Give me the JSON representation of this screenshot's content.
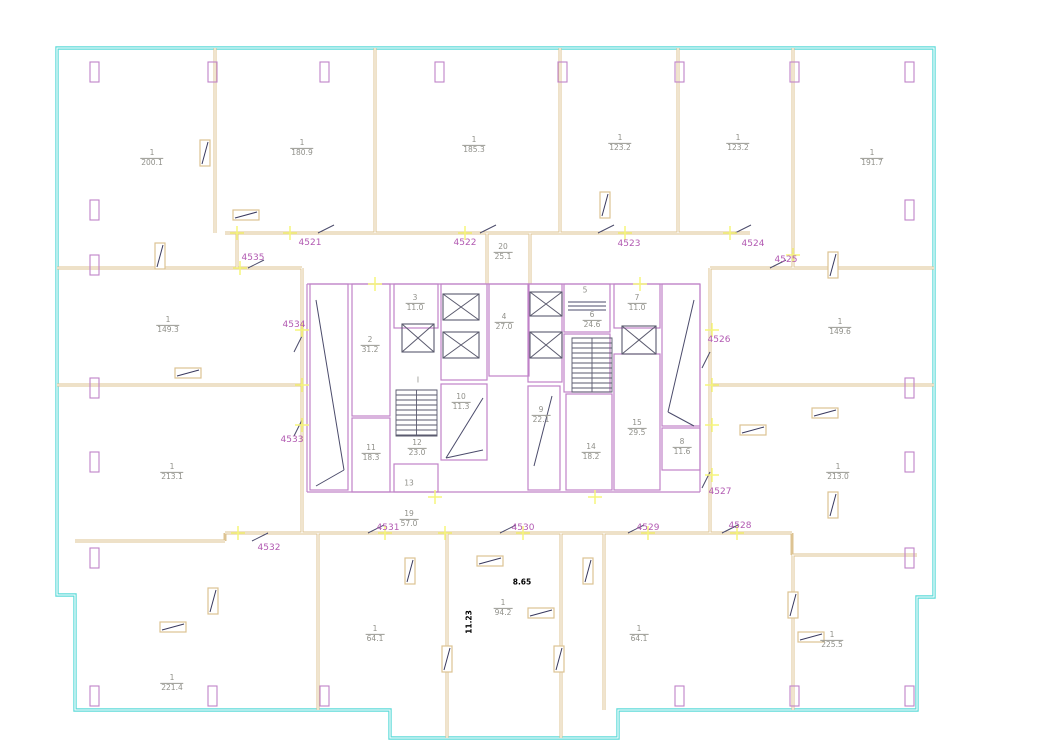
{
  "colors": {
    "boundary": "#5cdad8",
    "wall": "#ddc392",
    "partition": "#c083c8",
    "unit_text": "#b25ab2",
    "room_text": "#90908a",
    "dimension_text": "#000000",
    "junction_cross": "#f5f57c",
    "detail": "#4b4b6b"
  },
  "rooms": {
    "a1": {
      "num": "1",
      "area": "200.1"
    },
    "a2": {
      "num": "1",
      "area": "180.9"
    },
    "a3": {
      "num": "1",
      "area": "185.3"
    },
    "a4": {
      "num": "1",
      "area": "123.2"
    },
    "a5": {
      "num": "1",
      "area": "123.2"
    },
    "a6": {
      "num": "1",
      "area": "191.7"
    },
    "a7": {
      "num": "20",
      "area": "25.1"
    },
    "a8": {
      "num": "1",
      "area": "149.3"
    },
    "a9": {
      "num": "1",
      "area": "149.6"
    },
    "a10": {
      "num": "2",
      "area": "31.2"
    },
    "a11": {
      "num": "3",
      "area": "11.0"
    },
    "a12": {
      "num": "4",
      "area": "27.0"
    },
    "a13": {
      "num": "6",
      "area": "24.6"
    },
    "a14": {
      "num": "7",
      "area": "11.0"
    },
    "a15": {
      "num": "10",
      "area": "11.3"
    },
    "a16": {
      "num": "9",
      "area": "22.1"
    },
    "a17": {
      "num": "11",
      "area": "18.3"
    },
    "a18": {
      "num": "12",
      "area": "23.0"
    },
    "a19": {
      "num": "14",
      "area": "18.2"
    },
    "a20": {
      "num": "15",
      "area": "29.5"
    },
    "a21": {
      "num": "8",
      "area": "11.6"
    },
    "a22": {
      "num": "1",
      "area": "213.1"
    },
    "a23": {
      "num": "1",
      "area": "213.0"
    },
    "a24": {
      "num": "19",
      "area": "57.0"
    },
    "a25": {
      "num": "1",
      "area": "94.2"
    },
    "a26": {
      "num": "1",
      "area": "64.1"
    },
    "a27": {
      "num": "1",
      "area": "64.1"
    },
    "a28": {
      "num": "1",
      "area": "225.5"
    },
    "a29": {
      "num": "1",
      "area": "221.4"
    }
  },
  "marks": {
    "s1": "5",
    "s2": "I",
    "s3": "13"
  },
  "units": {
    "u4521": "4521",
    "u4522": "4522",
    "u4523": "4523",
    "u4524": "4524",
    "u4525": "4525",
    "u4526": "4526",
    "u4527": "4527",
    "u4528": "4528",
    "u4529": "4529",
    "u4530": "4530",
    "u4531": "4531",
    "u4532": "4532",
    "u4533": "4533",
    "u4534": "4534",
    "u4535": "4535"
  },
  "dims": {
    "d1": "8.65",
    "d2": "11.23"
  }
}
